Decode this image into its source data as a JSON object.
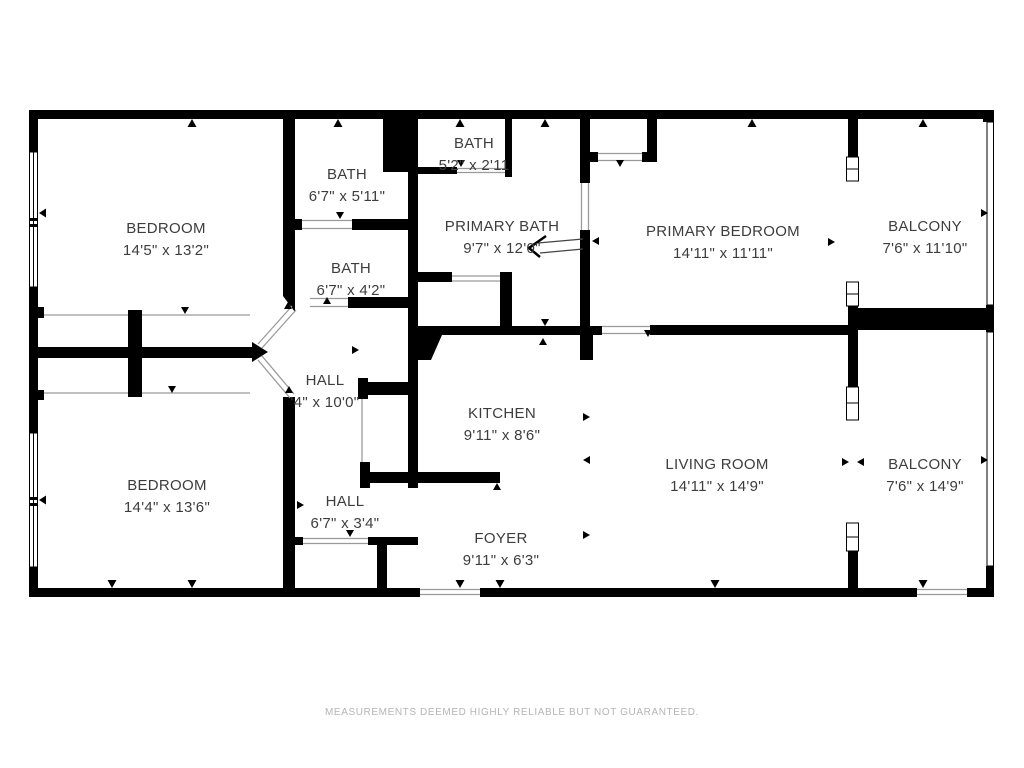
{
  "floorplan": {
    "wall_color": "#000000",
    "label_color": "#3d3d3d",
    "opening_line_color": "#9a9a9a",
    "rooms": [
      {
        "id": "bedroom-top",
        "name": "BEDROOM",
        "dims": "14'5\" x 13'2\"",
        "x": 166,
        "y": 233
      },
      {
        "id": "bath-top",
        "name": "BATH",
        "dims": "6'7\" x 5'11\"",
        "x": 347,
        "y": 179
      },
      {
        "id": "bath-small",
        "name": "BATH",
        "dims": "5'2\" x 2'11",
        "x": 474,
        "y": 148
      },
      {
        "id": "primary-bath",
        "name": "PRIMARY BATH",
        "dims": "9'7\" x 12'0\"",
        "x": 502,
        "y": 231
      },
      {
        "id": "primary-bedroom",
        "name": "PRIMARY BEDROOM",
        "dims": "14'11\" x 11'11\"",
        "x": 723,
        "y": 236
      },
      {
        "id": "balcony-top",
        "name": "BALCONY",
        "dims": "7'6\" x 11'10\"",
        "x": 925,
        "y": 231
      },
      {
        "id": "bath-mid",
        "name": "BATH",
        "dims": "6'7\" x 4'2\"",
        "x": 351,
        "y": 273
      },
      {
        "id": "hall-main",
        "name": "HALL",
        "dims": "'4\" x 10'0\"",
        "x": 325,
        "y": 385
      },
      {
        "id": "kitchen",
        "name": "KITCHEN",
        "dims": "9'11\" x 8'6\"",
        "x": 502,
        "y": 418
      },
      {
        "id": "living-room",
        "name": "LIVING ROOM",
        "dims": "14'11\" x 14'9\"",
        "x": 717,
        "y": 469
      },
      {
        "id": "balcony-bottom",
        "name": "BALCONY",
        "dims": "7'6\" x 14'9\"",
        "x": 925,
        "y": 469
      },
      {
        "id": "bedroom-bottom",
        "name": "BEDROOM",
        "dims": "14'4\" x 13'6\"",
        "x": 167,
        "y": 490
      },
      {
        "id": "hall-small",
        "name": "HALL",
        "dims": "6'7\" x 3'4\"",
        "x": 345,
        "y": 506
      },
      {
        "id": "foyer",
        "name": "FOYER",
        "dims": "9'11\" x 6'3\"",
        "x": 501,
        "y": 543
      }
    ]
  },
  "footer": {
    "disclaimer": "MEASUREMENTS DEEMED HIGHLY RELIABLE BUT NOT GUARANTEED."
  }
}
